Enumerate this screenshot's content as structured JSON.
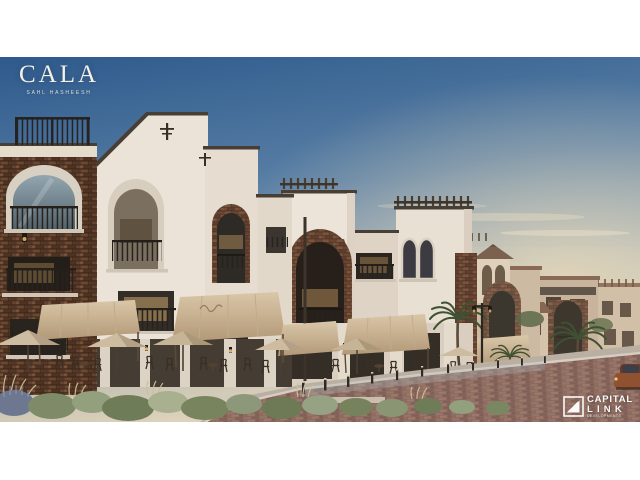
{
  "page": {
    "background": "#ffffff"
  },
  "photo": {
    "top_px": 57,
    "height_px": 365,
    "subject": "Dusk street view rendering of a Mediterranean-style low-rise residential promenade with white stucco towers, stone-clad arches, rooftop pergolas, canvas awnings, cafe umbrellas and seating, landscaped shrubs, bollards and a brick-paved road receding to distant beige buildings, a small cupola tower and palm trees"
  },
  "branding": {
    "cala": {
      "title": "CALA",
      "subtitle": "SAHL HASHEESH",
      "text_color": "#f4f0e6"
    },
    "developer": {
      "name_line1": "CAPITAL",
      "name_line2": "LINK",
      "tagline": "DEVELOPMENTS",
      "text_color": "#ffffff"
    }
  },
  "palette": {
    "sky_top": "#2e5a8c",
    "sky_mid": "#7e9ab3",
    "horizon_glow": "#e9d9bc",
    "stucco": "#ebe3d7",
    "stucco_shadow": "#d8cec0",
    "stone_brick": "#6e4a36",
    "dark_openings": "#2b2520",
    "awning_canvas": "#cdb999",
    "roof_tile": "#7d5340",
    "foliage_green": "#7a8661",
    "foliage_dry": "#c7b98e",
    "road_pavers": "#8b685d",
    "warm_window_light": "#e6bb77"
  }
}
